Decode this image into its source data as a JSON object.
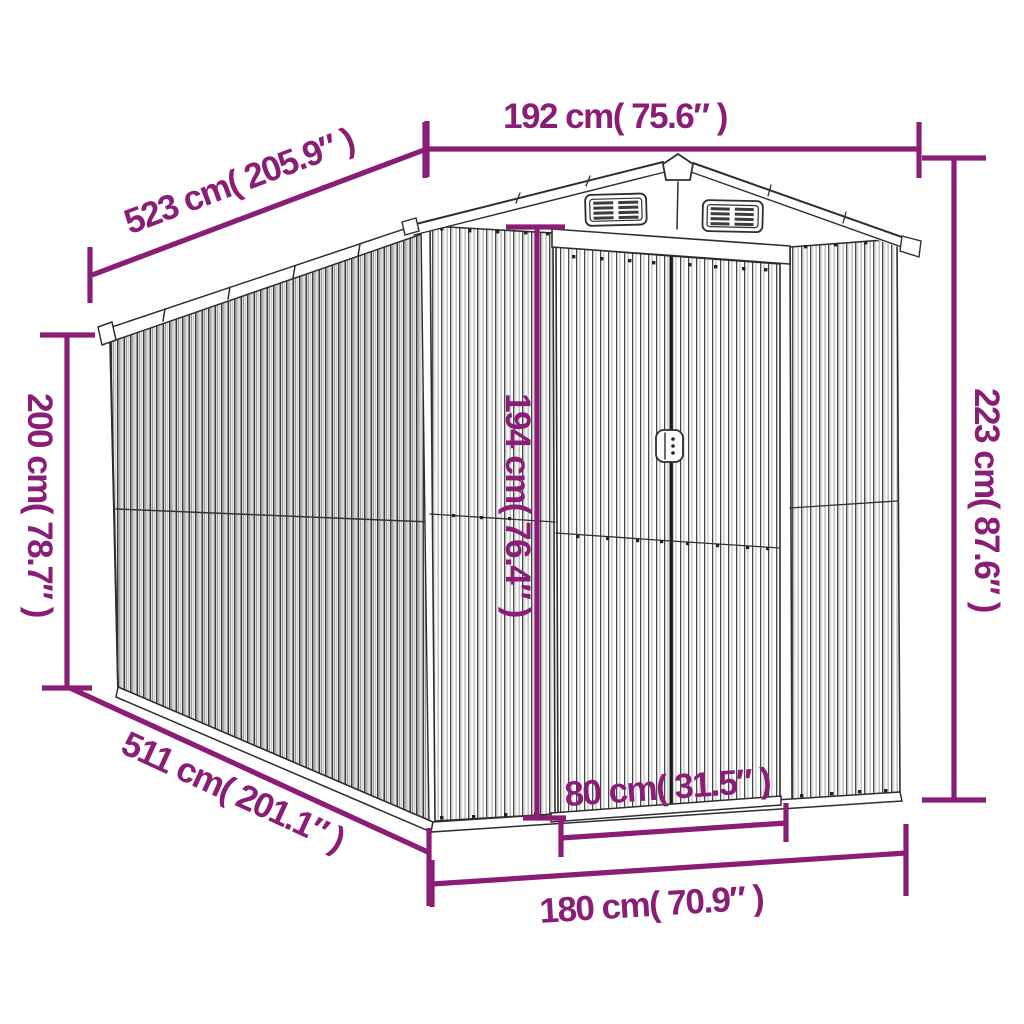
{
  "meta": {
    "title": "Garden shed dimension diagram",
    "subject": "metal garden shed line drawing with measurements"
  },
  "style": {
    "dimension_color": "#8A1E76",
    "outline_color": "#2E2E2E",
    "background": "#FFFFFF"
  },
  "dimensions": {
    "roof_width": {
      "label": "192 cm( 75.6″ )"
    },
    "ridge_length": {
      "label": "523 cm( 205.9″ )"
    },
    "wall_height": {
      "label": "200 cm( 78.7″ )"
    },
    "total_height": {
      "label": "223 cm( 87.6″ )"
    },
    "door_height": {
      "label": "194 cm( 76.4″ )"
    },
    "base_length": {
      "label": "511 cm( 201.1″ )"
    },
    "door_width": {
      "label": "80 cm( 31.5″ )"
    },
    "base_width": {
      "label": "180 cm( 70.9″ )"
    }
  }
}
